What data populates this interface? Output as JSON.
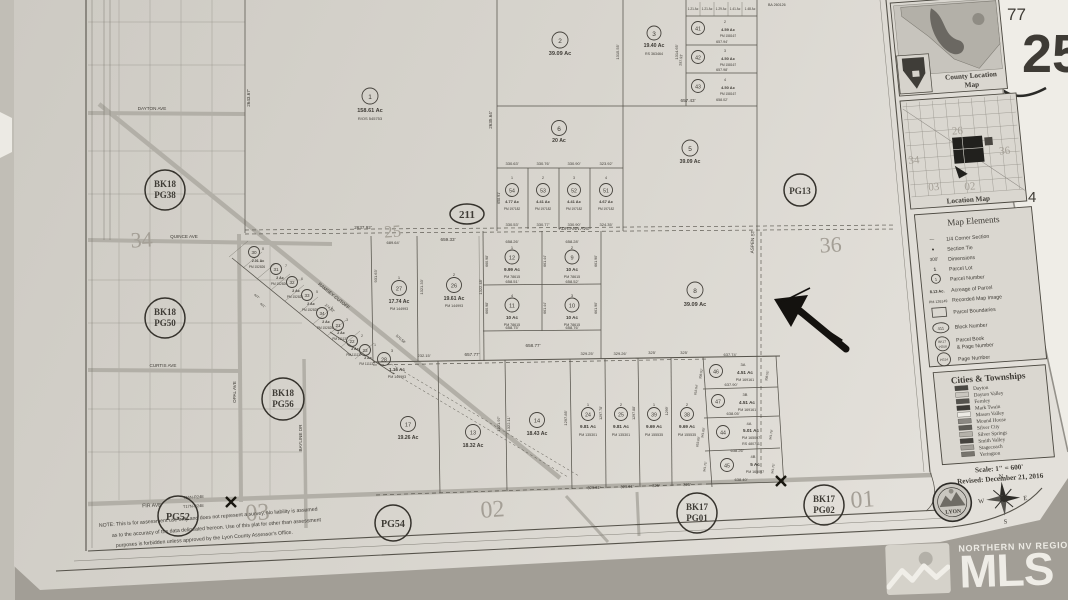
{
  "underlay": {
    "num_top": "77",
    "num_big": "25",
    "num_side": "4"
  },
  "watermark": {
    "region": "NORTHERN NV REGIONAL",
    "brand": "MLS"
  },
  "shield": {
    "label": "211"
  },
  "township_labels": {
    "top": "T16N-R24E",
    "bottom": "T17N-R24E"
  },
  "note": {
    "line1": "NOTE:  This is for assessment use only and does not represent a survey.  No liability is assumed",
    "line2": "as to the accuracy of the data delineated hereon.  Use of this plat for other than assessment",
    "line3": "purposes is forbidden unless approved by the Lyon County Assessor's Office."
  },
  "streets": {
    "dayton": "DAYTON AVE",
    "quince": "QUINCE AVE",
    "curtis": "CURTIS AVE",
    "fir": "FIR AVE",
    "adriann": "ADRIANN AVE",
    "opal": "OPAL AVE",
    "bayline": "BAYLINE DR",
    "ramsey": "RAMSEY CUTOFF",
    "aspen": "ASPEN ST"
  },
  "sections": {
    "s34": "34",
    "s25": "25",
    "s36": "36",
    "s03": "03",
    "s02": "02",
    "s01": "01"
  },
  "misc": {
    "ba": "BA 260126"
  },
  "page_refs": [
    {
      "l1": "BK18",
      "l2": "PG38"
    },
    {
      "l1": "BK18",
      "l2": "PG50"
    },
    {
      "l1": "BK18",
      "l2": "PG56"
    },
    {
      "l1": "PG52",
      "l2": ""
    },
    {
      "l1": "PG54",
      "l2": ""
    },
    {
      "l1": "BK17",
      "l2": "PG01"
    },
    {
      "l1": "BK17",
      "l2": "PG02"
    },
    {
      "l1": "PG13",
      "l2": ""
    }
  ],
  "small_lots": [
    "1.21 Ac",
    "1.21 Ac",
    "1.29 Ac",
    "1.41 Ac",
    "1.48 Ac"
  ],
  "parcels": [
    {
      "n": "1",
      "ac": "158.61 Ac",
      "pm": "R/OS 545753"
    },
    {
      "n": "2",
      "ac": "39.09 Ac"
    },
    {
      "n": "3",
      "ac": "19.40 Ac",
      "pm": "RS 363464"
    },
    {
      "n": "6",
      "ac": "20 Ac"
    },
    {
      "n": "5",
      "ac": "39.09 Ac"
    },
    {
      "lot": "2",
      "n": "41",
      "ac": "4.59 Ac",
      "pm": "PM 158167"
    },
    {
      "lot": "3",
      "n": "42",
      "ac": "4.50 Ac",
      "pm": "PM 158167"
    },
    {
      "lot": "4",
      "n": "43",
      "ac": "4.50 Ac",
      "pm": "PM 158167"
    },
    {
      "lot": "1",
      "n": "54",
      "ac": "4.77 Ac",
      "pm": "PM 197182"
    },
    {
      "lot": "2",
      "n": "53",
      "ac": "4.41 Ac",
      "pm": "PM 197182"
    },
    {
      "lot": "3",
      "n": "52",
      "ac": "4.41 Ac",
      "pm": "PM 197182"
    },
    {
      "lot": "4",
      "n": "51",
      "ac": "4.67 Ac",
      "pm": "PM 197182"
    },
    {
      "lot": "1",
      "n": "12",
      "ac": "9.99 Ac",
      "pm": "PM 78615"
    },
    {
      "lot": "2",
      "n": "9",
      "ac": "10 Ac",
      "pm": "PM 78615"
    },
    {
      "lot": "4",
      "n": "11",
      "ac": "10 Ac",
      "pm": "PM 78615"
    },
    {
      "lot": "3",
      "n": "10",
      "ac": "10 Ac",
      "pm": "PM 78615"
    },
    {
      "n": "8",
      "ac": "39.09 Ac"
    },
    {
      "lot": "1",
      "n": "27",
      "ac": "17.74 Ac",
      "pm": "PM 144993"
    },
    {
      "lot": "2",
      "n": "26",
      "ac": "19.61 Ac",
      "pm": "PM 144993"
    },
    {
      "lot": "3",
      "n": "28",
      "ac": "1.16 Ac",
      "pm": "PM 144993"
    },
    {
      "n": "17",
      "ac": "19.26 Ac"
    },
    {
      "n": "13",
      "ac": "18.32 Ac"
    },
    {
      "n": "14",
      "ac": "18.43 Ac"
    },
    {
      "lot": "1",
      "n": "24",
      "ac": "9.81 Ac",
      "pm": "PM 135301"
    },
    {
      "lot": "2",
      "n": "25",
      "ac": "9.81 Ac",
      "pm": "PM 135301"
    },
    {
      "lot": "1",
      "n": "39",
      "ac": "9.69 Ac",
      "pm": "PM 155535"
    },
    {
      "lot": "2",
      "n": "38",
      "ac": "9.69 Ac",
      "pm": "PM 155535"
    },
    {
      "lot": "3A",
      "n": "46",
      "ac": "4.51 Ac",
      "pm": "PM 169161"
    },
    {
      "lot": "3B",
      "n": "47",
      "ac": "4.51 Ac",
      "pm": "PM 169161"
    },
    {
      "lot": "4A",
      "n": "44",
      "ac": "5.01 Ac",
      "pm": "PM 165007",
      "pm2": "RS 480711"
    },
    {
      "lot": "4B",
      "n": "45",
      "ac": "5 Ac",
      "pm": "PM 165007"
    },
    {
      "lot": "8",
      "n": "30",
      "ac": "2.01 Ac",
      "pm": "PM 152826"
    },
    {
      "lot": "7",
      "n": "31",
      "ac": "2 Ac",
      "pm": "PM 152826"
    },
    {
      "lot": "6",
      "n": "32",
      "ac": "2 Ac",
      "pm": "PM 152826"
    },
    {
      "lot": "5",
      "n": "33",
      "ac": "2 Ac",
      "pm": "PM 152825"
    },
    {
      "lot": "4",
      "n": "34",
      "ac": "2 Ac",
      "pm": "PM 152825"
    },
    {
      "lot": "3",
      "n": "21",
      "ac": "2 Ac",
      "pm": "PM 111137"
    },
    {
      "lot": "2",
      "n": "22",
      "ac": "2 Ac",
      "pm": "PM 111137"
    },
    {
      "lot": "1",
      "n": "23",
      "ac": "2 Ac",
      "pm": "PM 111137"
    }
  ],
  "dims": [
    "2643.67'",
    "2635.64'",
    "1315.55'",
    "657.43'",
    "657.94'",
    "657.98'",
    "658.02'",
    "330.63'",
    "330.76'",
    "330.90'",
    "323.92'",
    "330.53'",
    "330.77'",
    "330.90'",
    "324.35'",
    "2637.92'",
    "689.64'",
    "659.33'",
    "658.26'",
    "658.28'",
    "658.51'",
    "658.52'",
    "658.75'",
    "658.76'",
    "658.77'",
    "657.77'",
    "232.15'",
    "329.25'",
    "329.26'",
    "325'",
    "329.61'",
    "931.63'",
    "1321.33'",
    "1322.48'",
    "660.98'",
    "661.44'",
    "661.90'",
    "1321.97'",
    "1322.11'",
    "1297.85'",
    "1297.78'",
    "1297.88'",
    "1299'",
    "637.74'",
    "637.90'",
    "638.05'",
    "638.26'",
    "638.40'",
    "341.80'",
    "341.75'",
    "308.02'",
    "308.55'",
    "616.04'",
    "653.60'",
    "274.82'",
    "570.58'",
    "407'",
    "401'",
    "297.93'",
    "341.79'",
    "658.91'",
    "1314.65'"
  ],
  "legend": {
    "map_elements": {
      "title": "Map Elements",
      "items": [
        {
          "sym": "—",
          "label": "1/4 Corner Section"
        },
        {
          "sym": "●",
          "label": "Section Tie"
        },
        {
          "sym": "300'",
          "label": "Dimensions"
        },
        {
          "sym": "1",
          "label": "Parcel Lot"
        },
        {
          "sym": "1",
          "label": "Parcel Number"
        },
        {
          "sym": "8.13 Ac.",
          "label": "Acreage of Parcel"
        },
        {
          "sym": "PM 126149",
          "label": "Recorded Map Image"
        },
        {
          "sym": "",
          "label": "Parcel Boundaries"
        },
        {
          "sym": "411",
          "label": "Block Number"
        },
        {
          "sym_l1": "BK17",
          "sym_l2": "PG08",
          "label_l1": "Parcel Book",
          "label_l2": "& Page Number"
        },
        {
          "sym": "PG24",
          "label": "Page Number"
        }
      ]
    },
    "cities": {
      "title": "Cities & Townships",
      "items": [
        "Dayton",
        "Dayton Valley",
        "Fernley",
        "Mark Twain",
        "Mason Valley",
        "Mound House",
        "Silver City",
        "Silver Springs",
        "Smith Valley",
        "Stagecoach",
        "Yerington"
      ]
    },
    "scale": "Scale: 1\" = 600'",
    "revised": "Revised: December 21, 2016"
  },
  "county_map": {
    "title_line1": "County Location",
    "title_line2": "Map"
  },
  "location_map": {
    "title": "Location Map",
    "sections": [
      "26",
      "36",
      "34",
      "03",
      "02"
    ]
  },
  "compass": {
    "n": "N",
    "e": "E",
    "s": "S",
    "w": "W"
  },
  "seal": {
    "county": "LYON"
  }
}
